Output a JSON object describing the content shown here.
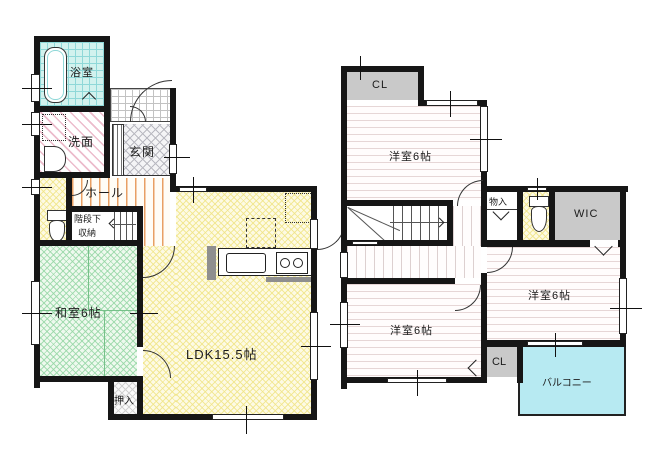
{
  "colors": {
    "wall": "#161616",
    "ldk_hatch": "#f0e485",
    "tatami_hatch": "#94d6a4",
    "bath_grid": "#8fd8d8",
    "washroom_stripe": "#ecbccc",
    "hall_stripe": "#e8a064",
    "bedroom_stripe": "#e6d6d6",
    "entrance_hatch": "#b9b9c1",
    "closet_fill": "#c9c9c9",
    "balcony_fill": "#b7eaf2"
  },
  "floor1": {
    "bathroom": {
      "label": "浴室"
    },
    "washroom": {
      "label": "洗面"
    },
    "entrance": {
      "label": "玄関"
    },
    "hall": {
      "label": "ホール"
    },
    "under_stair_storage": {
      "label_line1": "階段下",
      "label_line2": "収納"
    },
    "japanese_room": {
      "label": "和室6帖"
    },
    "ldk": {
      "label": "LDK15.5帖"
    },
    "oshiire": {
      "label": "押入"
    }
  },
  "floor2": {
    "closet_top": {
      "label": "CL"
    },
    "bedroom_north": {
      "label": "洋室6帖"
    },
    "storage": {
      "label": "物入"
    },
    "wic": {
      "label": "WIC"
    },
    "bedroom_west": {
      "label": "洋室6帖"
    },
    "bedroom_east": {
      "label": "洋室6帖"
    },
    "closet_south": {
      "label": "CL"
    },
    "balcony": {
      "label": "バルコニー"
    }
  }
}
